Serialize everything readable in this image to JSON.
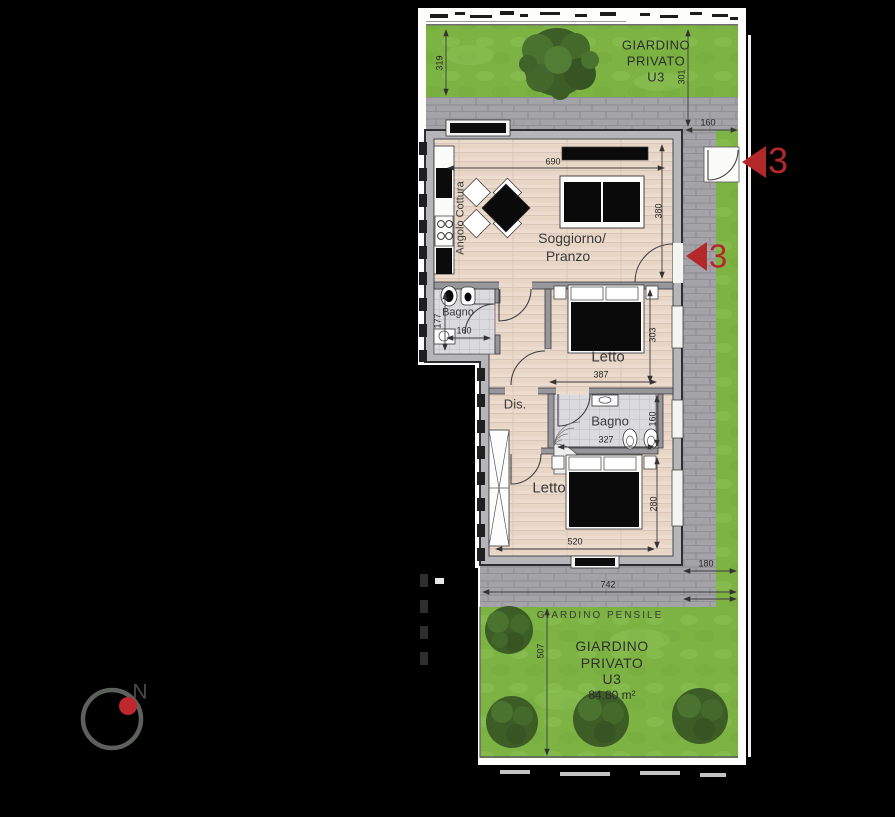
{
  "plan": {
    "compass_north": "N",
    "entry_marker_gate": "3",
    "entry_marker_door": "3",
    "garden_top": {
      "l1": "GIARDINO",
      "l2": "PRIVATO",
      "l3": "U3",
      "dim_left": "319",
      "dim_right": "301",
      "dim_gate": "160"
    },
    "living": {
      "l1": "Soggiorno/",
      "l2": "Pranzo",
      "dim_w": "690",
      "dim_h": "380"
    },
    "kitchen_label": "Angolo Cottura",
    "bath1": {
      "label": "Bagno",
      "dim_h": "177",
      "dim_w": "160"
    },
    "bed1": {
      "label": "Letto",
      "dim_h": "303",
      "dim_w": "387"
    },
    "hall_label": "Dis.",
    "bath2": {
      "label": "Bagno",
      "dim_w": "327",
      "dim_h": "160"
    },
    "bed2": {
      "label": "Letto",
      "dim_w": "520",
      "dim_h": "280"
    },
    "terrace": {
      "dim_w": "742",
      "dim_corner": "180",
      "pensile_label": "GIARDINO PENSILE"
    },
    "garden_bottom": {
      "l1": "GIARDINO",
      "l2": "PRIVATO",
      "l3": "U3",
      "area": "84.80 m²",
      "dim_h": "507"
    },
    "colors": {
      "grass": "#7db343",
      "paving": "#a4a4a8",
      "wood": "#ecdccd",
      "red": "#b3282a"
    }
  }
}
